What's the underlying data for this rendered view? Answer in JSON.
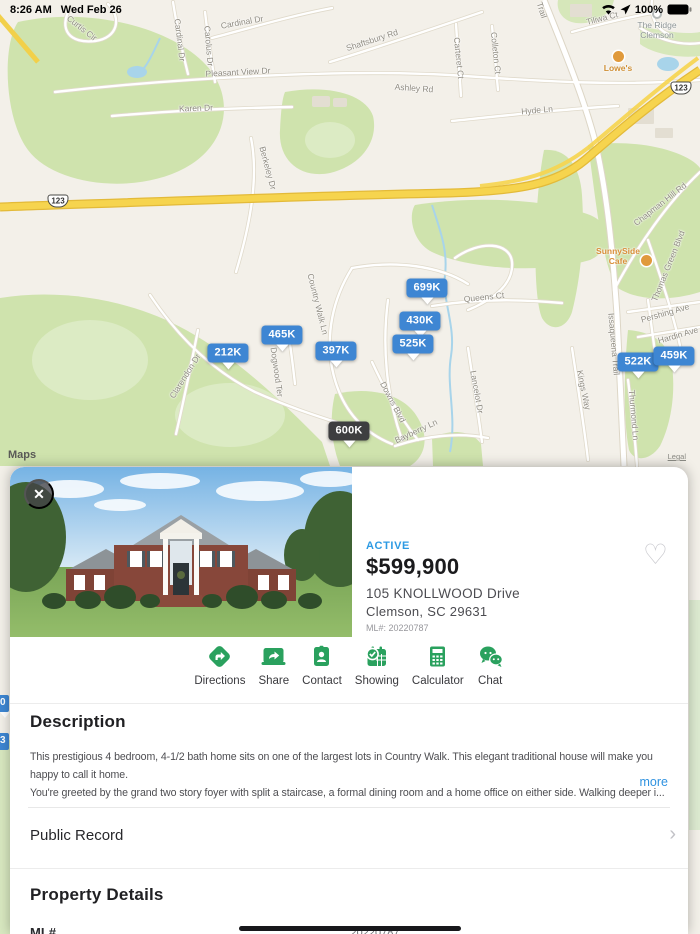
{
  "status_bar": {
    "time": "8:26 AM",
    "date": "Wed Feb 26",
    "battery": "100%"
  },
  "icons": {
    "close": "✕",
    "heart": "♡",
    "chevron_right": "›"
  },
  "map": {
    "attribution": "Maps",
    "legal": "Legal",
    "shields": [
      "123",
      "123"
    ],
    "pin_colors": {
      "blue": "#3E86D3",
      "dark": "#3E3E40"
    },
    "pins": [
      {
        "label": "699K",
        "x": 427,
        "y": 288,
        "color": "blue"
      },
      {
        "label": "430K",
        "x": 420,
        "y": 321,
        "color": "blue"
      },
      {
        "label": "525K",
        "x": 413,
        "y": 344,
        "color": "blue"
      },
      {
        "label": "465K",
        "x": 282,
        "y": 335,
        "color": "blue"
      },
      {
        "label": "397K",
        "x": 336,
        "y": 351,
        "color": "blue"
      },
      {
        "label": "212K",
        "x": 228,
        "y": 353,
        "color": "blue"
      },
      {
        "label": "522K",
        "x": 638,
        "y": 362,
        "color": "blue"
      },
      {
        "label": "459K",
        "x": 674,
        "y": 356,
        "color": "blue"
      },
      {
        "label": "600K",
        "x": 349,
        "y": 431,
        "color": "dark"
      }
    ],
    "edge_pins": [
      "0",
      "3"
    ],
    "pois": {
      "loews": {
        "name": "Lowe's"
      },
      "ridge": {
        "line1": "The Ridge",
        "line2": "Clemson"
      },
      "cafe": {
        "line1": "SunnySide",
        "line2": "Cafe"
      }
    },
    "street_labels": [
      {
        "text": "Curtis Cir",
        "x": 82,
        "y": 28,
        "rot": 38
      },
      {
        "text": "Cardinal Dr",
        "x": 180,
        "y": 40,
        "rot": 83
      },
      {
        "text": "Carolus Dr",
        "x": 209,
        "y": 46,
        "rot": 85
      },
      {
        "text": "Cardinal Dr",
        "x": 242,
        "y": 22,
        "rot": -10
      },
      {
        "text": "Pleasant View Dr",
        "x": 238,
        "y": 72,
        "rot": -3
      },
      {
        "text": "Karen Dr",
        "x": 196,
        "y": 108,
        "rot": -2
      },
      {
        "text": "Shaftsbury Rd",
        "x": 372,
        "y": 40,
        "rot": -18
      },
      {
        "text": "Carteret Ct",
        "x": 459,
        "y": 58,
        "rot": 84
      },
      {
        "text": "Colleton Ct",
        "x": 496,
        "y": 53,
        "rot": 84
      },
      {
        "text": "Ashley Rd",
        "x": 414,
        "y": 88,
        "rot": 4
      },
      {
        "text": "Hyde Ln",
        "x": 537,
        "y": 110,
        "rot": -5
      },
      {
        "text": "Tiliwa Ct",
        "x": 602,
        "y": 18,
        "rot": -14
      },
      {
        "text": "Trail",
        "x": 542,
        "y": 10,
        "rot": 72
      },
      {
        "text": "Berkeley Dr",
        "x": 268,
        "y": 168,
        "rot": 75
      },
      {
        "text": "Chapman Hill Rd",
        "x": 660,
        "y": 204,
        "rot": -38
      },
      {
        "text": "Thomas Green Blvd",
        "x": 668,
        "y": 266,
        "rot": -68
      },
      {
        "text": "Queens Ct",
        "x": 484,
        "y": 297,
        "rot": -6
      },
      {
        "text": "Issaqueena Trail",
        "x": 614,
        "y": 344,
        "rot": 85
      },
      {
        "text": "Country Walk Ln",
        "x": 318,
        "y": 304,
        "rot": 76
      },
      {
        "text": "Dogwood Ter",
        "x": 277,
        "y": 372,
        "rot": 82
      },
      {
        "text": "Clarendon Dr",
        "x": 185,
        "y": 376,
        "rot": -58
      },
      {
        "text": "Downs Blvd",
        "x": 393,
        "y": 402,
        "rot": 62
      },
      {
        "text": "Bayberry Ln",
        "x": 416,
        "y": 431,
        "rot": -25
      },
      {
        "text": "Lancelot Dr",
        "x": 477,
        "y": 392,
        "rot": 80
      },
      {
        "text": "Kings Way",
        "x": 584,
        "y": 390,
        "rot": 78
      },
      {
        "text": "Pershing Ave",
        "x": 665,
        "y": 313,
        "rot": -16
      },
      {
        "text": "Hardin Ave",
        "x": 678,
        "y": 335,
        "rot": -16
      },
      {
        "text": "Thurmond Ln",
        "x": 634,
        "y": 415,
        "rot": 85
      }
    ]
  },
  "sheet": {
    "status": "ACTIVE",
    "price": "$599,900",
    "address_line1": "105 KNOLLWOOD Drive",
    "address_line2": "Clemson, SC 29631",
    "mls": "ML#: 20220787",
    "actions": [
      {
        "label": "Directions"
      },
      {
        "label": "Share"
      },
      {
        "label": "Contact"
      },
      {
        "label": "Showing"
      },
      {
        "label": "Calculator"
      },
      {
        "label": "Chat"
      }
    ],
    "description": {
      "heading": "Description",
      "lines": [
        "This prestigious 4 bedroom, 4-1/2 bath home sits on one of the largest lots in Country Walk. This elegant traditional house will make you happy to call it home.",
        "You're greeted by the grand two story foyer with split a staircase, a formal dining room and a home office on either side. Walking deeper i..."
      ],
      "more": "more"
    },
    "public_record": "Public Record",
    "property_details": {
      "heading": "Property Details",
      "rows": [
        {
          "label": "ML#",
          "value": "20220787"
        }
      ]
    }
  }
}
